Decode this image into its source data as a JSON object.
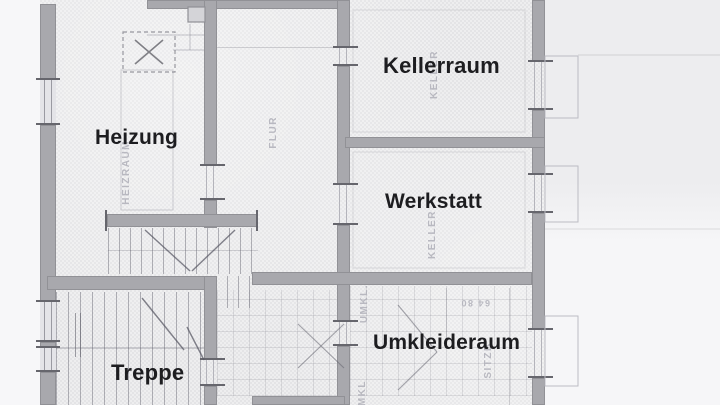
{
  "plan": {
    "labels": {
      "heizung": "Heizung",
      "kellerraum": "Kellerraum",
      "werkstatt": "Werkstatt",
      "umkleideraum": "Umkleideraum",
      "treppe": "Treppe"
    },
    "ghost_texts": {
      "flur": "FLUR",
      "heizraum": "HEIZRAUM",
      "keller_upper": "KELLER",
      "keller_lower": "KELLER",
      "umkl": "UMKL.",
      "umkl_clipped": "UMKL",
      "sitzb": "SITZB.",
      "dim_upside_down": "64 80"
    }
  },
  "colors": {
    "paper": "#e9e9eb",
    "paper_outside": "#f7f7f9",
    "wall": "#a8a8ad",
    "wall_edge": "#7d7d84",
    "thin_line": "#9a9aa2",
    "ghost_text": "#b0b0b9",
    "label_text": "#1d1d20"
  }
}
